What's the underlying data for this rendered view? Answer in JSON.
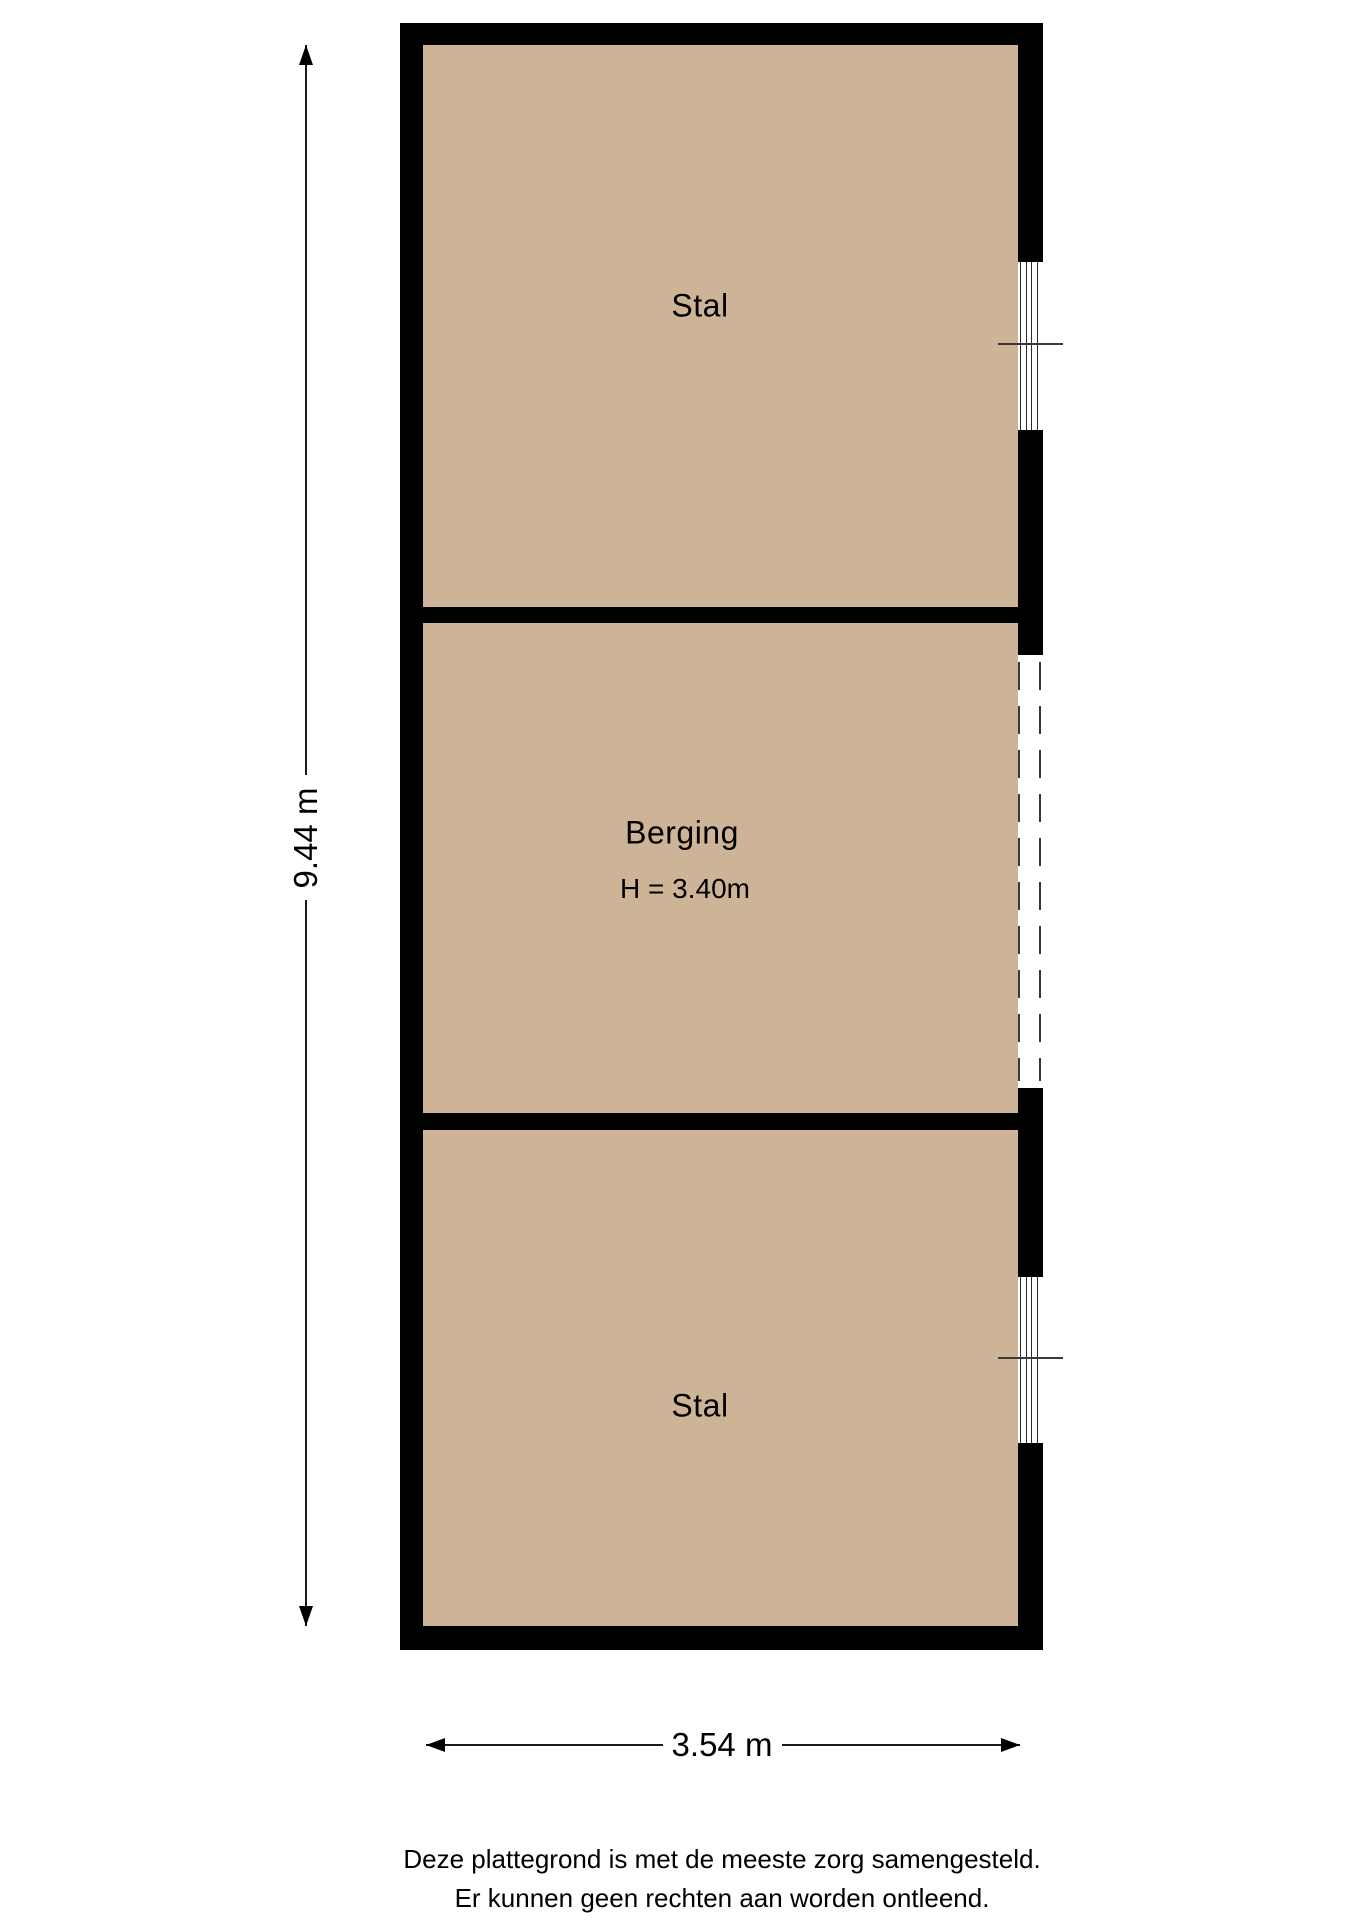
{
  "rooms": [
    {
      "label": "Stal"
    },
    {
      "label": "Berging",
      "height_note": "H = 3.40m"
    },
    {
      "label": "Stal"
    }
  ],
  "dimensions": {
    "vertical": "9.44 m",
    "horizontal": "3.54 m"
  },
  "footer": {
    "line1": "Deze plattegrond is met de meeste zorg samengesteld.",
    "line2": "Er kunnen geen rechten aan worden ontleend."
  },
  "colors": {
    "room_fill": "#cdb496",
    "wall": "#000000"
  }
}
